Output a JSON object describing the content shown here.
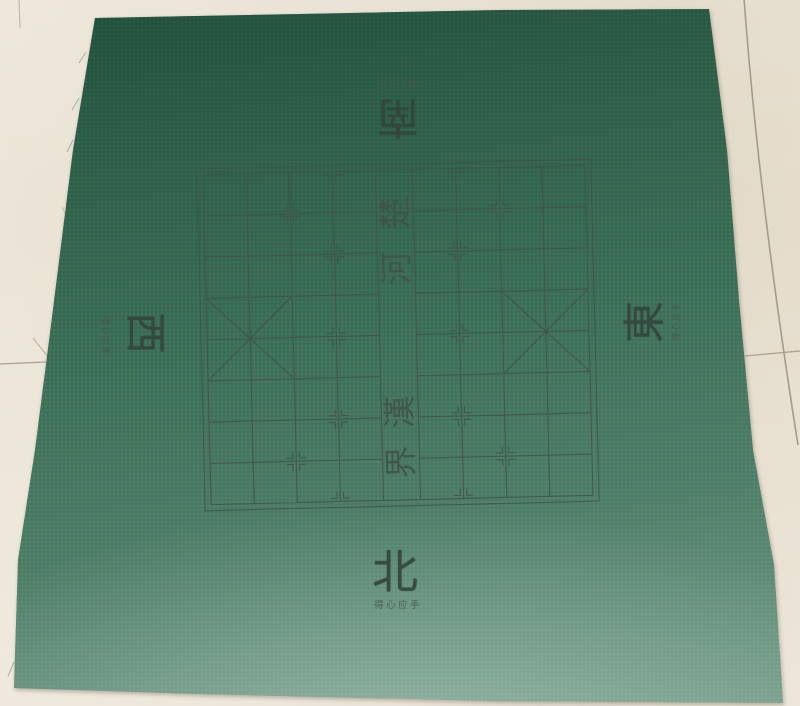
{
  "floor": {
    "tile_color": "#e8e0d1",
    "tile_color_light": "#ece5d7",
    "tile_color_shaded": "#e1d8c7",
    "grout_color": "#a49b8c"
  },
  "mat": {
    "fabric_color": "#3e7159",
    "fabric_color_dark": "#2c6850",
    "fabric_color_light": "#6f9484",
    "ink_color": "#42524a"
  },
  "compass": {
    "south": {
      "char": "南",
      "slogan": "得心应手"
    },
    "north": {
      "char": "北",
      "slogan": "得心应手"
    },
    "west": {
      "char": "西",
      "slogan": "得心应手"
    },
    "east": {
      "char": "東",
      "slogan": "得心应手"
    }
  },
  "board": {
    "type": "xiangqi",
    "river_text_top": [
      "楚",
      "河"
    ],
    "river_text_bottom": [
      "漢",
      "界"
    ],
    "x": 207,
    "y": 170,
    "width": 382,
    "height": 330,
    "river_width": 37,
    "rotation_deg": -1.4,
    "outer_offset": 6,
    "line_color": "#42524a",
    "palace_rows": [
      3,
      5
    ],
    "markers": {
      "cannon_cols": [
        2,
        7
      ],
      "cannon_rows": [
        1,
        7
      ],
      "soldier_cols": [
        3,
        6
      ],
      "soldier_rows": [
        0,
        2,
        4,
        6,
        8
      ]
    }
  }
}
